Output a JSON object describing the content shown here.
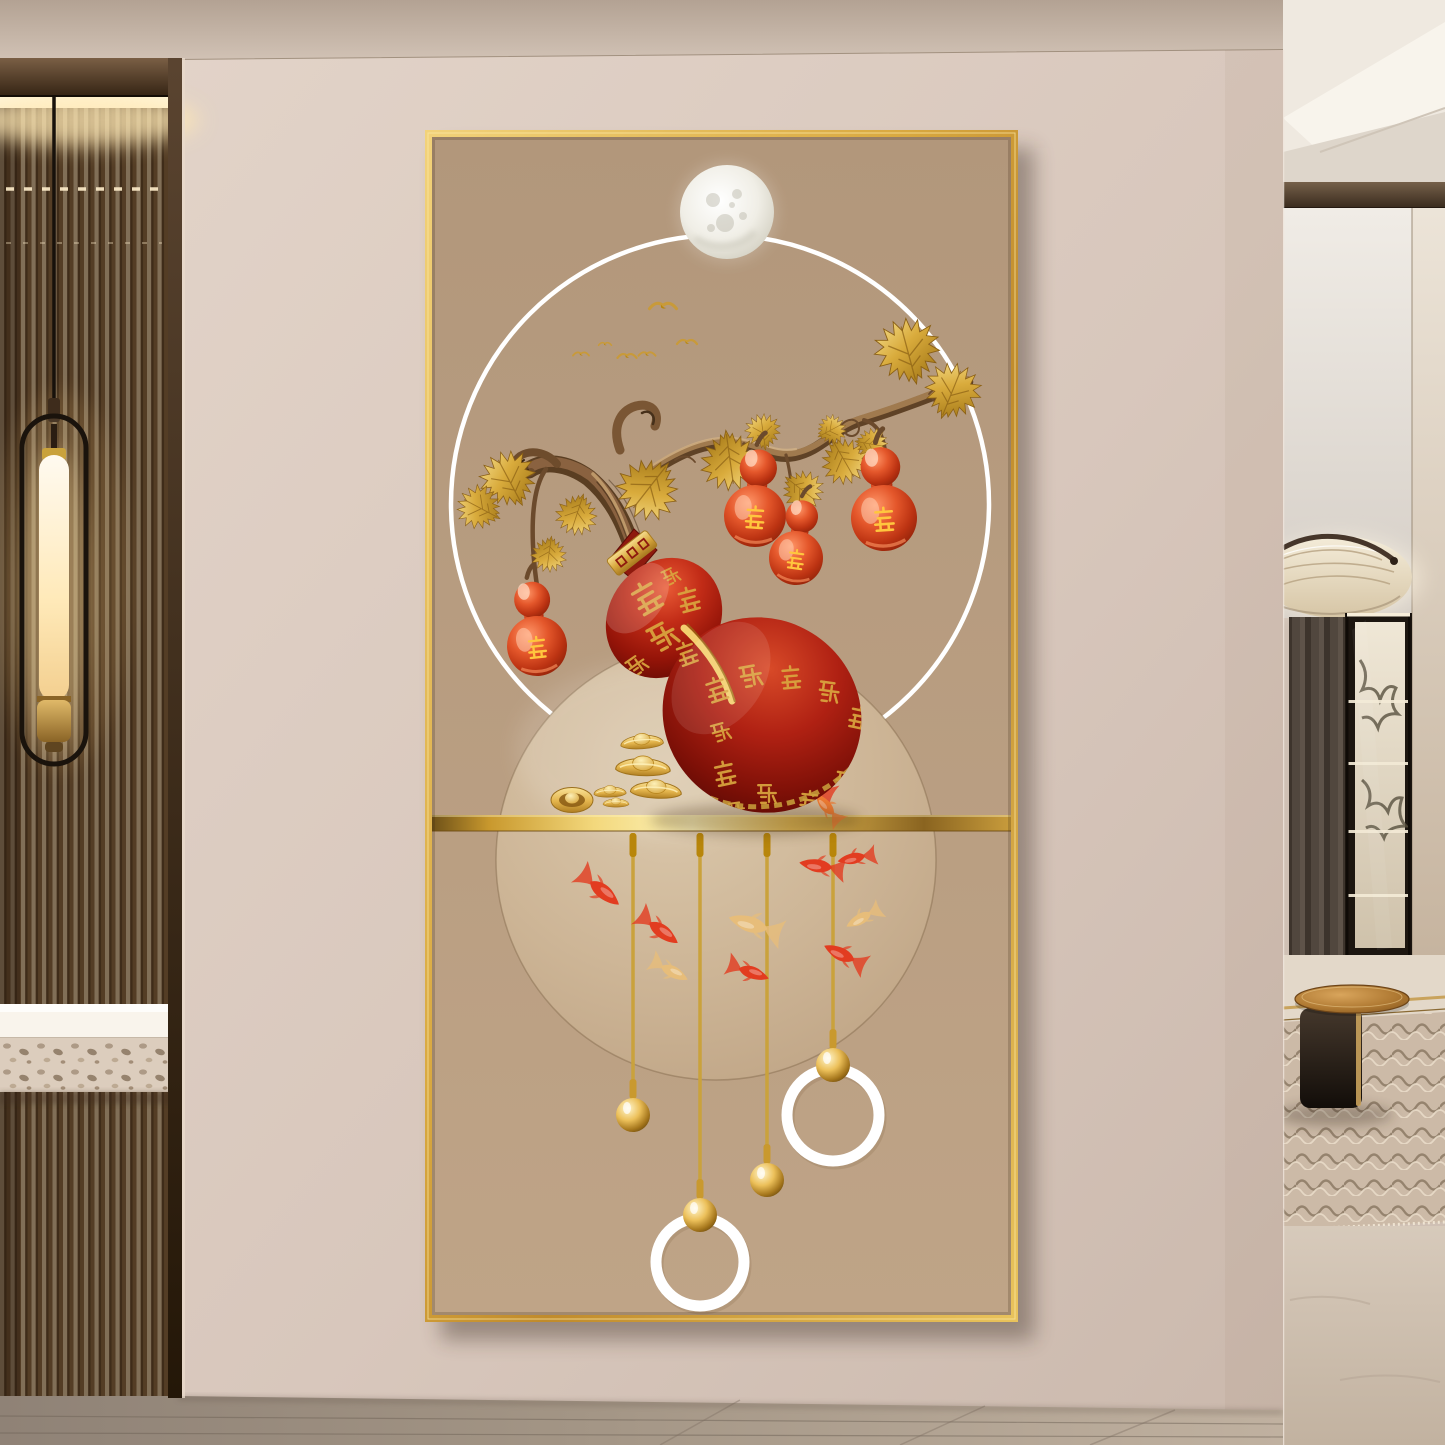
{
  "scene": {
    "label": "Modern beige hallway with a gold-framed Chinese fortune-gourd crystal painting; fluted glass partition and pendant lamp at left, living room with chandelier, display cabinet and round side table at right"
  },
  "palette": {
    "wall": "#dbcabf",
    "canvas_tan": "#b89d81",
    "frame_gold": "#e3b74e",
    "deep_red": "#a81b10",
    "bright_gold": "#f3d87c",
    "ring_white": "#ffffff",
    "inner_circle_tan": "#cdb596",
    "koi_red": "#e23c20",
    "koi_gold": "#e7bd7a",
    "branch_brown": "#8a6240"
  },
  "painting": {
    "characters": {
      "fu": "福",
      "lu": "禄",
      "shou": "寿",
      "xi": "喜",
      "cai": "财",
      "ping": "平",
      "an": "安"
    },
    "fu_main": {
      "ch": "福",
      "x": 371,
      "y": 612,
      "s": 0.95,
      "r": -12
    },
    "label_gourds": [
      {
        "ch": "禄",
        "x": 112,
        "y": 516,
        "s": 1.5,
        "r": -6
      },
      {
        "ch": "寿",
        "x": 330,
        "y": 386,
        "s": 1.55,
        "r": 4
      },
      {
        "ch": "喜",
        "x": 371,
        "y": 428,
        "s": 1.35,
        "r": 8
      },
      {
        "ch": "财",
        "x": 459,
        "y": 388,
        "s": 1.65,
        "r": -4
      }
    ],
    "calligraphy": [
      {
        "ch": "平",
        "x": 222,
        "y": 468,
        "s": 1.15,
        "r": -30
      },
      {
        "ch": "安",
        "x": 238,
        "y": 506,
        "s": 1.15,
        "r": -28
      },
      {
        "ch": "福",
        "x": 264,
        "y": 470,
        "s": 0.9,
        "r": -15
      },
      {
        "ch": "福",
        "x": 212,
        "y": 535,
        "s": 0.8,
        "r": -35
      },
      {
        "ch": "禄",
        "x": 262,
        "y": 524,
        "s": 0.85,
        "r": -20
      },
      {
        "ch": "福",
        "x": 246,
        "y": 446,
        "s": 0.7,
        "r": -25
      },
      {
        "ch": "福",
        "x": 292,
        "y": 560,
        "s": 0.9,
        "r": -18
      },
      {
        "ch": "禄",
        "x": 326,
        "y": 546,
        "s": 0.95,
        "r": -10
      },
      {
        "ch": "福",
        "x": 366,
        "y": 548,
        "s": 0.85,
        "r": -5
      },
      {
        "ch": "财",
        "x": 404,
        "y": 562,
        "s": 0.9,
        "r": 8
      },
      {
        "ch": "福",
        "x": 434,
        "y": 588,
        "s": 0.85,
        "r": 12
      },
      {
        "ch": "财",
        "x": 296,
        "y": 602,
        "s": 0.8,
        "r": -15
      },
      {
        "ch": "福",
        "x": 300,
        "y": 644,
        "s": 0.9,
        "r": -12
      },
      {
        "ch": "禄",
        "x": 342,
        "y": 664,
        "s": 0.85,
        "r": 0
      },
      {
        "ch": "福",
        "x": 384,
        "y": 672,
        "s": 0.8,
        "r": 6
      },
      {
        "ch": "寿",
        "x": 420,
        "y": 652,
        "s": 0.85,
        "r": 10
      },
      {
        "ch": "福",
        "x": 446,
        "y": 622,
        "s": 0.8,
        "r": 14
      },
      {
        "ch": "寿",
        "x": 312,
        "y": 680,
        "s": 0.7,
        "r": -8
      },
      {
        "ch": "福",
        "x": 352,
        "y": 700,
        "s": 0.75,
        "r": 2
      },
      {
        "ch": "禄",
        "x": 428,
        "y": 700,
        "s": 0.7,
        "r": 10
      }
    ],
    "moon": {
      "x": 302,
      "y": 82,
      "r": 47,
      "craters": [
        [
          288,
          70,
          7
        ],
        [
          312,
          64,
          5
        ],
        [
          300,
          93,
          9
        ],
        [
          318,
          86,
          4
        ],
        [
          286,
          98,
          4
        ],
        [
          307,
          75,
          3
        ]
      ]
    },
    "birds": [
      {
        "x": 238,
        "y": 176,
        "s": 1.35
      },
      {
        "x": 262,
        "y": 212,
        "s": 1.0
      },
      {
        "x": 156,
        "y": 224,
        "s": 0.8
      },
      {
        "x": 202,
        "y": 226,
        "s": 0.95
      },
      {
        "x": 222,
        "y": 224,
        "s": 0.85
      },
      {
        "x": 180,
        "y": 214,
        "s": 0.65
      }
    ],
    "leaves": [
      {
        "x": 483,
        "y": 222,
        "r": -15,
        "s": 1.1
      },
      {
        "x": 527,
        "y": 262,
        "r": 22,
        "s": 0.95
      },
      {
        "x": 419,
        "y": 330,
        "r": 150,
        "s": 0.8
      },
      {
        "x": 377,
        "y": 360,
        "r": 128,
        "s": 0.7
      },
      {
        "x": 305,
        "y": 330,
        "r": 172,
        "s": 1.0
      },
      {
        "x": 224,
        "y": 358,
        "r": -142,
        "s": 1.05
      },
      {
        "x": 152,
        "y": 384,
        "r": -162,
        "s": 0.7
      },
      {
        "x": 84,
        "y": 350,
        "r": -28,
        "s": 0.95
      },
      {
        "x": 55,
        "y": 378,
        "r": -62,
        "s": 0.75
      },
      {
        "x": 124,
        "y": 424,
        "r": -172,
        "s": 0.6
      },
      {
        "x": 338,
        "y": 302,
        "r": -8,
        "s": 0.6
      },
      {
        "x": 406,
        "y": 300,
        "r": 62,
        "s": 0.5
      },
      {
        "x": 446,
        "y": 314,
        "r": 100,
        "s": 0.55
      }
    ],
    "fish": [
      {
        "x": 385,
        "y": 655,
        "r": 205,
        "s": 1.0,
        "c": "#e23c20"
      },
      {
        "x": 402,
        "y": 677,
        "r": 228,
        "s": 0.78,
        "c": "#ef7b33"
      },
      {
        "x": 176,
        "y": 760,
        "r": 38,
        "s": 1.05,
        "c": "#e23c20"
      },
      {
        "x": 235,
        "y": 800,
        "r": 35,
        "s": 1.0,
        "c": "#e23c20"
      },
      {
        "x": 246,
        "y": 841,
        "r": 26,
        "s": 0.85,
        "c": "#e7bd7a"
      },
      {
        "x": 328,
        "y": 795,
        "r": 196,
        "s": 1.15,
        "c": "#e7bd7a"
      },
      {
        "x": 325,
        "y": 842,
        "r": 18,
        "s": 0.9,
        "c": "#e23c20"
      },
      {
        "x": 395,
        "y": 736,
        "r": 188,
        "s": 0.95,
        "c": "#e23c20"
      },
      {
        "x": 430,
        "y": 728,
        "r": 168,
        "s": 0.8,
        "c": "#e23c20"
      },
      {
        "x": 418,
        "y": 825,
        "r": 205,
        "s": 0.95,
        "c": "#e23c20"
      },
      {
        "x": 437,
        "y": 788,
        "r": 150,
        "s": 0.8,
        "c": "#e7bd7a"
      }
    ],
    "strings": [
      {
        "x": 208,
        "ball_y": 985
      },
      {
        "x": 275,
        "ball_y": 1085,
        "ring_y": 1132,
        "ring_r": 44
      },
      {
        "x": 342,
        "ball_y": 1050
      },
      {
        "x": 408,
        "ball_y": 935,
        "ring_y": 985,
        "ring_r": 46
      }
    ],
    "ingots": [
      {
        "x": 217,
        "y": 612,
        "s": 0.82,
        "r": -4
      },
      {
        "x": 218,
        "y": 637,
        "s": 1.05,
        "r": 2
      },
      {
        "x": 185,
        "y": 662,
        "s": 0.62,
        "r": -2
      },
      {
        "x": 231,
        "y": 660,
        "s": 0.98,
        "r": 3
      },
      {
        "x": 191,
        "y": 673,
        "s": 0.5,
        "r": 0
      }
    ],
    "coin": {
      "x": 147,
      "y": 670
    }
  }
}
